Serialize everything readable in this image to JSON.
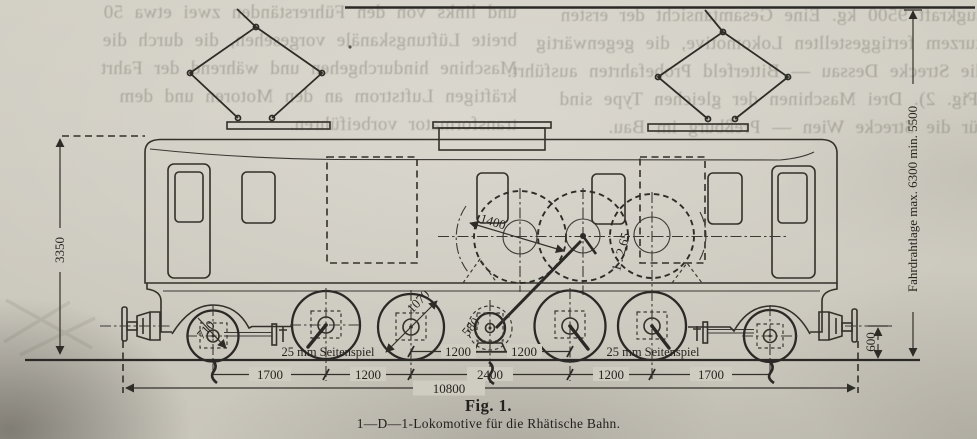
{
  "showthrough": {
    "left_lines": [
      "und links von den Führerständen zwei etwa 50",
      "breite Lüftungskanäle vorgesehen, die durch die",
      "Maschine hindurchgehen und während der Fahrt",
      "kräftigen Luftstrom an den Motoren und dem",
      "transformator vorbeiführen."
    ],
    "right_lines": [
      "zugkraft 9500 kg.  Eine Gesamtansicht der ersten",
      "kurzem fertiggestellten Lokomotive, die gegenwärtig",
      "die Strecke Dessau — Bitterfeld Probefahrten ausführt.",
      "(Fig. 2).  Drei Maschinen der gleichen Type sind",
      "für die Strecke Wien — Preßburg im Bau."
    ]
  },
  "figure": {
    "caption": {
      "title": "Fig. 1.",
      "subtitle": "1—D—1-Lokomotive für die Rhätische Bahn."
    },
    "dims": {
      "body_height": "3350",
      "contact_wire_range": "Fahrdrahtlage max. 6300 min. 5500",
      "buffer_height": "600",
      "total_wheelbase": "10800",
      "spacing_pony_front": "1700",
      "spacing_d1_d2": "1200",
      "spacing_d2_d3": "2400",
      "spacing_d3_d4": "1200",
      "spacing_pony_rear": "1700",
      "spacing_jack_left": "1200",
      "spacing_jack_right": "1200",
      "side_play_left": "25 mm Seitenspiel",
      "side_play_right": "25 mm Seitenspiel",
      "gear_circle": "1400",
      "gear_ratio": "1 : 2,65",
      "driver_dia": "1070",
      "jackshaft_dia": "580",
      "pony_dia": "710"
    }
  }
}
